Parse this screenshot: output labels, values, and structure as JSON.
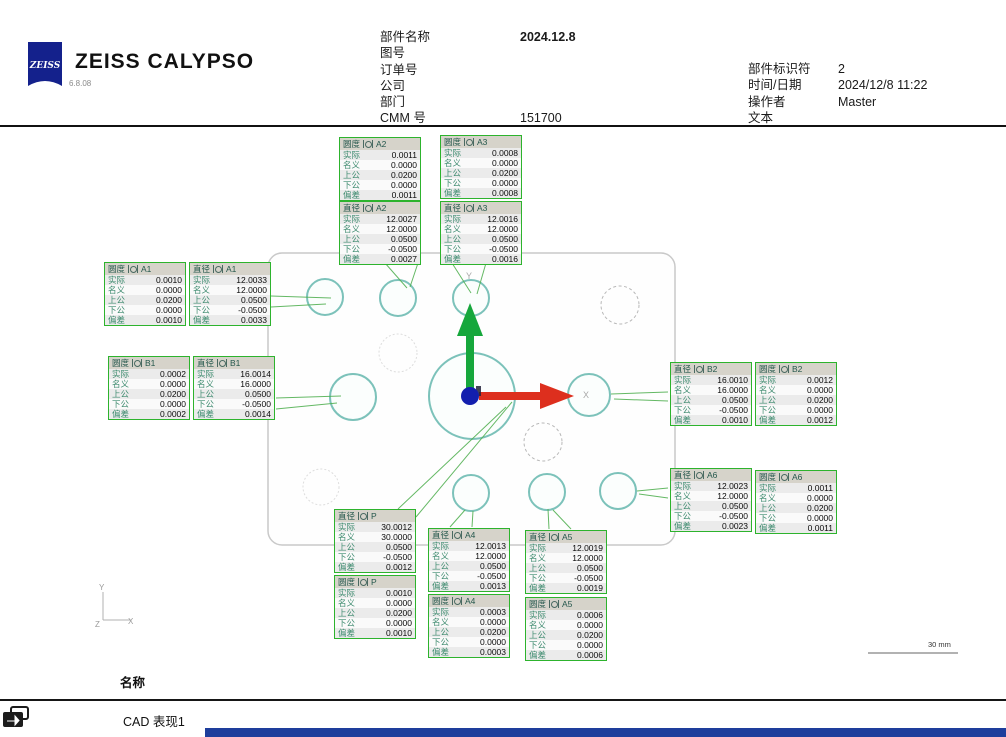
{
  "header": {
    "logo_text": "ZEISS",
    "app_title": "ZEISS  CALYPSO",
    "version": "6.8.08",
    "center_fields": [
      {
        "label": "部件名称",
        "value": "2024.12.8"
      },
      {
        "label": "图号",
        "value": ""
      },
      {
        "label": "订单号",
        "value": ""
      },
      {
        "label": "公司",
        "value": ""
      },
      {
        "label": "部门",
        "value": ""
      },
      {
        "label": "CMM 号",
        "value": "151700"
      }
    ],
    "right_fields": [
      {
        "label": "部件标识符",
        "value": "2"
      },
      {
        "label": "时间/日期",
        "value": "2024/12/8 11:22"
      },
      {
        "label": "操作者",
        "value": "Master"
      },
      {
        "label": "文本",
        "value": ""
      }
    ]
  },
  "callout_row_labels": [
    "实际",
    "名义",
    "上公",
    "下公",
    "偏差"
  ],
  "callout_row_keys": [
    "actual",
    "nominal",
    "upper_tol",
    "lower_tol",
    "deviation"
  ],
  "callouts": [
    {
      "id": "roundness-A2",
      "type": "圆度",
      "feature": "A2",
      "values": [
        "0.0011",
        "0.0000",
        "0.0200",
        "0.0000",
        "0.0011"
      ]
    },
    {
      "id": "roundness-A3",
      "type": "圆度",
      "feature": "A3",
      "values": [
        "0.0008",
        "0.0000",
        "0.0200",
        "0.0000",
        "0.0008"
      ]
    },
    {
      "id": "diameter-A2",
      "type": "直径",
      "feature": "A2",
      "values": [
        "12.0027",
        "12.0000",
        "0.0500",
        "-0.0500",
        "0.0027"
      ]
    },
    {
      "id": "diameter-A3",
      "type": "直径",
      "feature": "A3",
      "values": [
        "12.0016",
        "12.0000",
        "0.0500",
        "-0.0500",
        "0.0016"
      ]
    },
    {
      "id": "roundness-A1",
      "type": "圆度",
      "feature": "A1",
      "values": [
        "0.0010",
        "0.0000",
        "0.0200",
        "0.0000",
        "0.0010"
      ]
    },
    {
      "id": "diameter-A1",
      "type": "直径",
      "feature": "A1",
      "values": [
        "12.0033",
        "12.0000",
        "0.0500",
        "-0.0500",
        "0.0033"
      ]
    },
    {
      "id": "roundness-B1",
      "type": "圆度",
      "feature": "B1",
      "values": [
        "0.0002",
        "0.0000",
        "0.0200",
        "0.0000",
        "0.0002"
      ]
    },
    {
      "id": "diameter-B1",
      "type": "直径",
      "feature": "B1",
      "values": [
        "16.0014",
        "16.0000",
        "0.0500",
        "-0.0500",
        "0.0014"
      ]
    },
    {
      "id": "diameter-B2",
      "type": "直径",
      "feature": "B2",
      "values": [
        "16.0010",
        "16.0000",
        "0.0500",
        "-0.0500",
        "0.0010"
      ]
    },
    {
      "id": "roundness-B2",
      "type": "圆度",
      "feature": "B2",
      "values": [
        "0.0012",
        "0.0000",
        "0.0200",
        "0.0000",
        "0.0012"
      ]
    },
    {
      "id": "diameter-A6",
      "type": "直径",
      "feature": "A6",
      "values": [
        "12.0023",
        "12.0000",
        "0.0500",
        "-0.0500",
        "0.0023"
      ]
    },
    {
      "id": "roundness-A6",
      "type": "圆度",
      "feature": "A6",
      "values": [
        "0.0011",
        "0.0000",
        "0.0200",
        "0.0000",
        "0.0011"
      ]
    },
    {
      "id": "diameter-P",
      "type": "直径",
      "feature": "P",
      "values": [
        "30.0012",
        "30.0000",
        "0.0500",
        "-0.0500",
        "0.0012"
      ]
    },
    {
      "id": "roundness-P",
      "type": "圆度",
      "feature": "P",
      "values": [
        "0.0010",
        "0.0000",
        "0.0200",
        "0.0000",
        "0.0010"
      ]
    },
    {
      "id": "diameter-A4",
      "type": "直径",
      "feature": "A4",
      "values": [
        "12.0013",
        "12.0000",
        "0.0500",
        "-0.0500",
        "0.0013"
      ]
    },
    {
      "id": "roundness-A4",
      "type": "圆度",
      "feature": "A4",
      "values": [
        "0.0003",
        "0.0000",
        "0.0200",
        "0.0000",
        "0.0003"
      ]
    },
    {
      "id": "diameter-A5",
      "type": "直径",
      "feature": "A5",
      "values": [
        "12.0019",
        "12.0000",
        "0.0500",
        "-0.0500",
        "0.0019"
      ]
    },
    {
      "id": "roundness-A5",
      "type": "圆度",
      "feature": "A5",
      "values": [
        "0.0006",
        "0.0000",
        "0.0200",
        "0.0000",
        "0.0006"
      ]
    }
  ],
  "cad": {
    "axis_x_label": "X",
    "axis_y_label": "Y",
    "triad": {
      "x": "X",
      "y": "Y",
      "z": "Z"
    },
    "scale_bar_label": "30 mm"
  },
  "footer": {
    "name_header": "名称",
    "view_name": "CAD 表现1"
  },
  "icons": {
    "feature": "circle-feature-icon",
    "view": "cad-view-icon"
  },
  "colors": {
    "zeiss_blue": "#14218c",
    "callout_border_green": "#2db32d",
    "leader_green": "#54b154",
    "circle_teal": "#7cc2ba",
    "axis_green": "#16a73c",
    "axis_red": "#dd2f1e",
    "origin_blue": "#131fae",
    "bottom_bar_blue": "#1e3e9c"
  }
}
